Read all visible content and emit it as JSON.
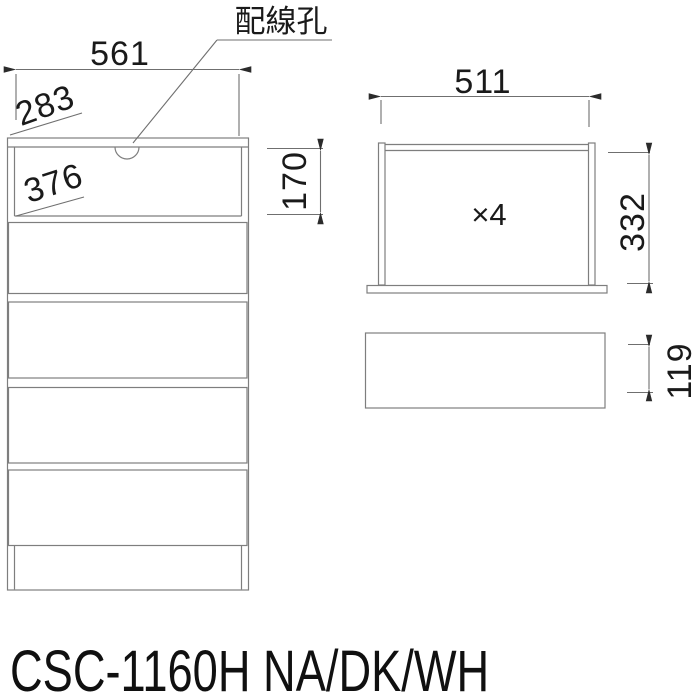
{
  "labels": {
    "wiring_hole": "配線孔",
    "quantity": "×4"
  },
  "front_view": {
    "overall_width": "561",
    "top_depth": "283",
    "inner_width": "376",
    "open_section_height": "170"
  },
  "drawer_detail": {
    "inner_width": "511",
    "inner_height": "332",
    "front_height": "119"
  },
  "product": {
    "model_code": "CSC-1160H NA/DK/WH"
  },
  "colors": {
    "line": "#7e7e7e",
    "dimension_line": "#6f6f6f",
    "ink": "#1a1a1a",
    "background": "#ffffff"
  }
}
